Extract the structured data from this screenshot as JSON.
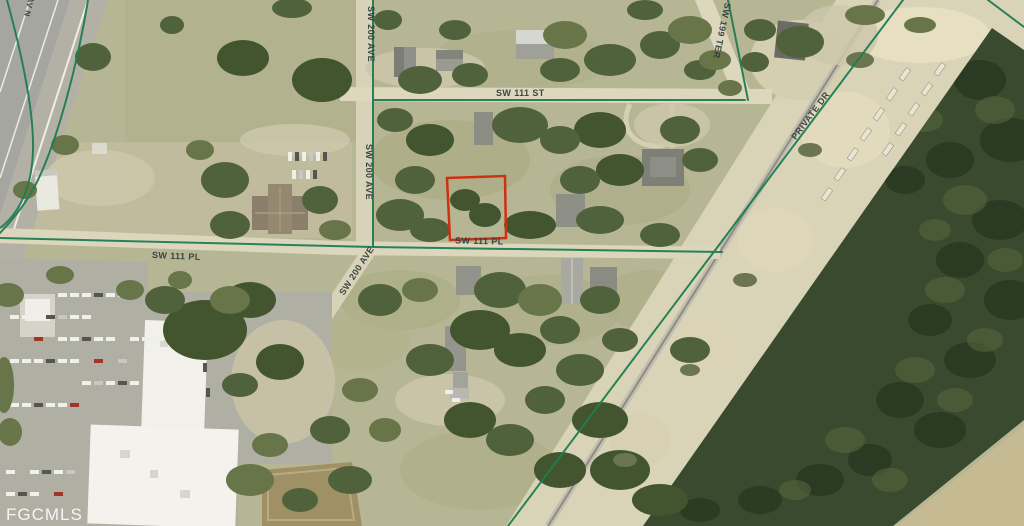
{
  "map": {
    "watermark": "FGCMLS",
    "street_labels": {
      "sw_200_ave": "SW 200 AVE",
      "sw_111_st": "SW 111 ST",
      "sw_199_ter": "SW 199 TER",
      "sw_111_pl": "SW 111 PL",
      "private_dr": "PRIVATE DR",
      "edge_fragment": "AV N"
    },
    "colors": {
      "street_overlay_green": "#1f7d52",
      "parcel_outline_red": "#cd3012",
      "street_label_text": "#2f3a3d",
      "watermark_text": "#ffffff"
    }
  }
}
